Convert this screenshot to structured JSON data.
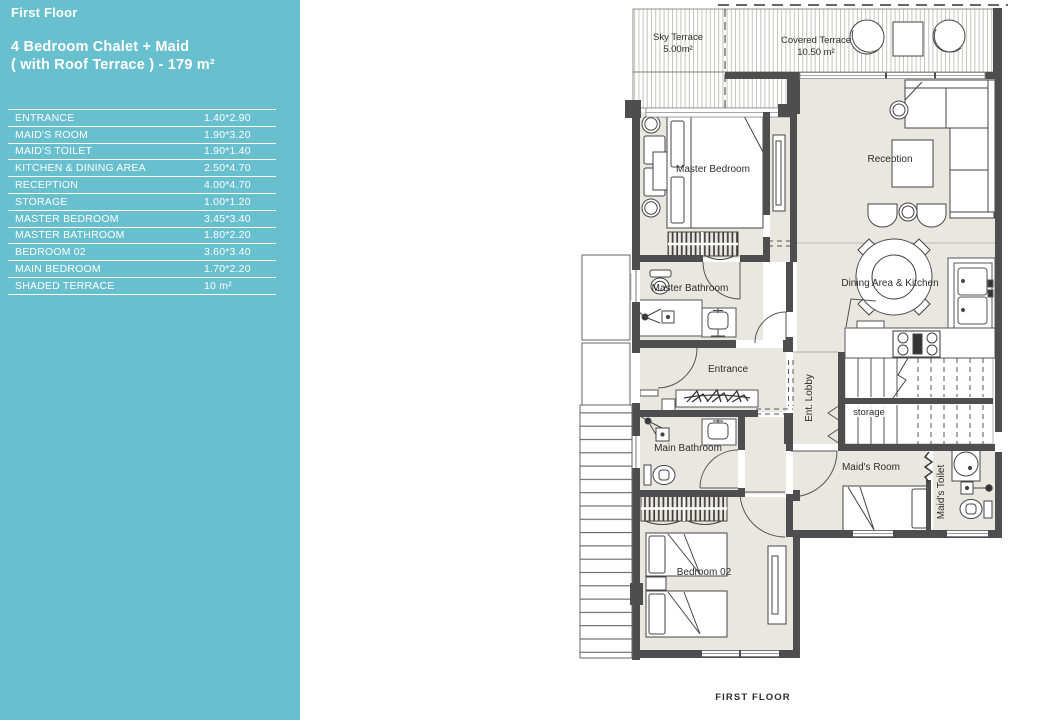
{
  "sidebar": {
    "bg_color": "#68bfce",
    "floor_label": "First Floor",
    "title_line1": "4 Bedroom Chalet + Maid",
    "title_line2": "( with Roof Terrace  ) - 179 m²",
    "rooms": [
      {
        "name": "ENTRANCE",
        "size": "1.40*2.90"
      },
      {
        "name": "MAID'S ROOM",
        "size": "1.90*3.20"
      },
      {
        "name": "MAID'S TOILET",
        "size": "1.90*1.40"
      },
      {
        "name": "KITCHEN & DINING AREA",
        "size": "2.50*4.70"
      },
      {
        "name": "RECEPTION",
        "size": "4.00*4.70"
      },
      {
        "name": "STORAGE",
        "size": "1.00*1.20"
      },
      {
        "name": "MASTER BEDROOM",
        "size": "3.45*3.40"
      },
      {
        "name": "MASTER BATHROOM",
        "size": "1.80*2.20"
      },
      {
        "name": "BEDROOM 02",
        "size": "3.60*3.40"
      },
      {
        "name": "MAIN BEDROOM",
        "size": "1.70*2.20"
      },
      {
        "name": "SHADED TERRACE",
        "size": "10 m²"
      }
    ]
  },
  "plan": {
    "labels": {
      "sky_terrace": "Sky Terrace",
      "sky_terrace_area": "5.00m²",
      "covered_terrace": "Covered Terrace",
      "covered_terrace_area": "10.50 m²",
      "master_bedroom": "Master Bedroom",
      "reception": "Reception",
      "master_bathroom": "Master  Bathroom",
      "dining_kitchen": "Dining Area & Kitchen",
      "entrance": "Entrance",
      "ent_lobby": "Ent. Lobby",
      "storage": "storage",
      "main_bathroom": "Main  Bathroom",
      "maids_room": "Maid's Room",
      "maids_toilet": "Maid's Toilet",
      "bedroom_02": "Bedroom 02"
    },
    "caption": "FIRST FLOOR",
    "caption_color": "#6cbcd9"
  }
}
